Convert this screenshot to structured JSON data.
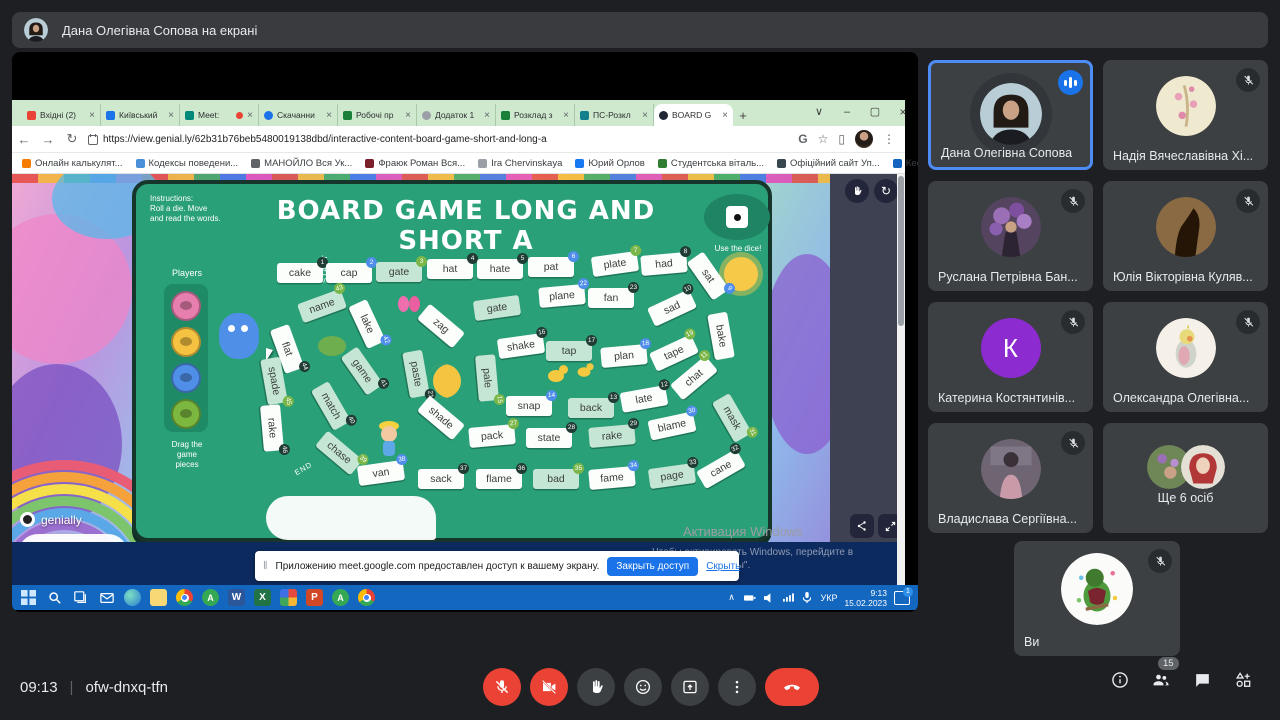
{
  "meet": {
    "banner_text": "Дана Олегівна Сопова на екрані",
    "time": "09:13",
    "code": "ofw-dnxq-tfn",
    "separator": "|",
    "participants_badge": "15"
  },
  "browser": {
    "tabs": [
      {
        "label": "Вхідні (2)",
        "ic": "#ea4335",
        "shape": "square"
      },
      {
        "label": "Київський",
        "ic": "#1a73e8",
        "shape": "square"
      },
      {
        "label": "Meet:",
        "ic": "#00897b",
        "shape": "square",
        "dot": true
      },
      {
        "label": "Скачанни",
        "ic": "#1a73e8",
        "shape": "circle"
      },
      {
        "label": "Робочі пр",
        "ic": "#188038",
        "shape": "square"
      },
      {
        "label": "Додаток 1",
        "ic": "#9aa0a6",
        "shape": "circle"
      },
      {
        "label": "Розклад з",
        "ic": "#188038",
        "shape": "square"
      },
      {
        "label": "ПС-Розкл",
        "ic": "#12808c",
        "shape": "square"
      },
      {
        "label": "BOARD G",
        "ic": "#202633",
        "shape": "circle",
        "active": true
      }
    ],
    "new_tab_button": "+",
    "close_glyph": "×",
    "window_controls": {
      "tab_search": "∨",
      "minimize": "–",
      "maximize": "▢",
      "close": "×"
    },
    "nav": {
      "back": "←",
      "forward": "→",
      "reload": "↻"
    },
    "url": "https://view.genial.ly/62b31b76beb5480019138dbd/interactive-content-board-game-short-and-long-a",
    "toolbar_right": {
      "g": "G",
      "star": "☆",
      "panel": "▯",
      "menu": "⋮"
    },
    "bookmarks": [
      {
        "label": "Онлайн калькулят...",
        "ic": "#f57c00"
      },
      {
        "label": "Кодексы поведени...",
        "ic": "#4a90d9"
      },
      {
        "label": "МАНОЙЛО Вся Ук...",
        "ic": "#5f6368"
      },
      {
        "label": "Фраюк Роман Вся...",
        "ic": "#7b1f2b"
      },
      {
        "label": "Ira Chervinskaya",
        "ic": "#9aa0a6"
      },
      {
        "label": "Юрий Орлов",
        "ic": "#1877f2"
      },
      {
        "label": "Студентська віталь...",
        "ic": "#2e7d32"
      },
      {
        "label": "Офіційний сайт Уп...",
        "ic": "#37474f"
      },
      {
        "label": "Кесем Султан - Все...",
        "ic": "#1565c0"
      }
    ],
    "bookmarks_overflow": "»"
  },
  "game": {
    "instructions_1": "Instructions:",
    "instructions_2": "Roll a die. Move",
    "instructions_3": "and read the words.",
    "title": "BOARD GAME LONG AND SHORT A",
    "use_dice": "Use the dice!",
    "players_label": "Players",
    "drag_label_1": "Drag the",
    "drag_label_2": "game",
    "drag_label_3": "pieces",
    "start_label": "START",
    "end_label": "END",
    "logo": "genially",
    "board_green": "#2aa078",
    "tiles": [
      {
        "word": "cake",
        "num": "1",
        "nc": "d",
        "x": 164,
        "y": 89,
        "r": 0,
        "bg": "w"
      },
      {
        "word": "cap",
        "num": "2",
        "nc": "b",
        "x": 213,
        "y": 89,
        "r": 0,
        "bg": "w"
      },
      {
        "word": "gate",
        "num": "3",
        "nc": "g",
        "x": 263,
        "y": 88,
        "r": 0,
        "bg": "g"
      },
      {
        "word": "hat",
        "num": "4",
        "nc": "d",
        "x": 314,
        "y": 85,
        "r": 0,
        "bg": "w"
      },
      {
        "word": "hate",
        "num": "5",
        "nc": "d",
        "x": 364,
        "y": 85,
        "r": 0,
        "bg": "w"
      },
      {
        "word": "pat",
        "num": "6",
        "nc": "b",
        "x": 415,
        "y": 83,
        "r": 0,
        "bg": "w"
      },
      {
        "word": "plate",
        "num": "7",
        "nc": "g",
        "x": 479,
        "y": 80,
        "r": -8,
        "bg": "w"
      },
      {
        "word": "had",
        "num": "8",
        "nc": "d",
        "x": 528,
        "y": 80,
        "r": -5,
        "bg": "w"
      },
      {
        "word": "sat",
        "num": "9",
        "nc": "b",
        "x": 572,
        "y": 92,
        "r": 55,
        "bg": "w"
      },
      {
        "word": "sad",
        "num": "10",
        "nc": "d",
        "x": 536,
        "y": 124,
        "r": -25,
        "bg": "w"
      },
      {
        "word": "bake",
        "num": "",
        "nc": "d",
        "x": 585,
        "y": 152,
        "r": 80,
        "bg": "w"
      },
      {
        "word": "name",
        "num": "43",
        "nc": "g",
        "x": 186,
        "y": 122,
        "r": -20,
        "bg": "g"
      },
      {
        "word": "lake",
        "num": "42",
        "nc": "b",
        "x": 231,
        "y": 140,
        "r": 65,
        "bg": "w"
      },
      {
        "word": "zag",
        "num": "",
        "nc": "d",
        "x": 305,
        "y": 142,
        "r": 40,
        "bg": "w"
      },
      {
        "word": "gate",
        "num": "",
        "nc": "g",
        "x": 361,
        "y": 124,
        "r": -8,
        "bg": "g"
      },
      {
        "word": "plane",
        "num": "22",
        "nc": "b",
        "x": 426,
        "y": 112,
        "r": -5,
        "bg": "w"
      },
      {
        "word": "fan",
        "num": "23",
        "nc": "d",
        "x": 475,
        "y": 114,
        "r": 0,
        "bg": "w"
      },
      {
        "word": "flat",
        "num": "44",
        "nc": "d",
        "x": 151,
        "y": 165,
        "r": 70,
        "bg": "w"
      },
      {
        "word": "shake",
        "num": "16",
        "nc": "d",
        "x": 385,
        "y": 162,
        "r": -8,
        "bg": "w"
      },
      {
        "word": "tap",
        "num": "17",
        "nc": "d",
        "x": 433,
        "y": 167,
        "r": 0,
        "bg": "g"
      },
      {
        "word": "plan",
        "num": "18",
        "nc": "b",
        "x": 488,
        "y": 172,
        "r": -5,
        "bg": "w"
      },
      {
        "word": "tape",
        "num": "19",
        "nc": "g",
        "x": 538,
        "y": 169,
        "r": -25,
        "bg": "w"
      },
      {
        "word": "spade",
        "num": "45",
        "nc": "g",
        "x": 138,
        "y": 197,
        "r": 80,
        "bg": "g"
      },
      {
        "word": "game",
        "num": "41",
        "nc": "d",
        "x": 226,
        "y": 187,
        "r": 55,
        "bg": "g"
      },
      {
        "word": "paste",
        "num": "21",
        "nc": "d",
        "x": 280,
        "y": 190,
        "r": 80,
        "bg": "g"
      },
      {
        "word": "pale",
        "num": "15",
        "nc": "g",
        "x": 351,
        "y": 194,
        "r": 85,
        "bg": "g"
      },
      {
        "word": "match",
        "num": "40",
        "nc": "d",
        "x": 195,
        "y": 222,
        "r": 60,
        "bg": "g"
      },
      {
        "word": "shade",
        "num": "",
        "nc": "b",
        "x": 305,
        "y": 234,
        "r": 40,
        "bg": "w"
      },
      {
        "word": "snap",
        "num": "14",
        "nc": "b",
        "x": 393,
        "y": 222,
        "r": 0,
        "bg": "w"
      },
      {
        "word": "back",
        "num": "13",
        "nc": "d",
        "x": 455,
        "y": 224,
        "r": 0,
        "bg": "g"
      },
      {
        "word": "late",
        "num": "12",
        "nc": "d",
        "x": 508,
        "y": 215,
        "r": -10,
        "bg": "w"
      },
      {
        "word": "chat",
        "num": "11",
        "nc": "g",
        "x": 558,
        "y": 194,
        "r": -40,
        "bg": "w"
      },
      {
        "word": "rake",
        "num": "46",
        "nc": "d",
        "x": 136,
        "y": 244,
        "r": 85,
        "bg": "w"
      },
      {
        "word": "chase",
        "num": "39",
        "nc": "g",
        "x": 203,
        "y": 269,
        "r": 40,
        "bg": "g"
      },
      {
        "word": "pack",
        "num": "27",
        "nc": "g",
        "x": 356,
        "y": 252,
        "r": -5,
        "bg": "w"
      },
      {
        "word": "state",
        "num": "28",
        "nc": "d",
        "x": 413,
        "y": 254,
        "r": 0,
        "bg": "w"
      },
      {
        "word": "rake",
        "num": "29",
        "nc": "d",
        "x": 476,
        "y": 252,
        "r": -5,
        "bg": "g"
      },
      {
        "word": "blame",
        "num": "30",
        "nc": "b",
        "x": 536,
        "y": 242,
        "r": -12,
        "bg": "w"
      },
      {
        "word": "mask",
        "num": "31",
        "nc": "g",
        "x": 596,
        "y": 234,
        "r": 60,
        "bg": "g"
      },
      {
        "word": "van",
        "num": "38",
        "nc": "b",
        "x": 245,
        "y": 289,
        "r": -8,
        "bg": "w"
      },
      {
        "word": "sack",
        "num": "37",
        "nc": "d",
        "x": 305,
        "y": 295,
        "r": 0,
        "bg": "w"
      },
      {
        "word": "flame",
        "num": "36",
        "nc": "d",
        "x": 363,
        "y": 295,
        "r": 0,
        "bg": "w"
      },
      {
        "word": "bad",
        "num": "35",
        "nc": "g",
        "x": 420,
        "y": 295,
        "r": 0,
        "bg": "g"
      },
      {
        "word": "fame",
        "num": "34",
        "nc": "b",
        "x": 476,
        "y": 294,
        "r": -5,
        "bg": "w"
      },
      {
        "word": "page",
        "num": "33",
        "nc": "d",
        "x": 536,
        "y": 292,
        "r": -8,
        "bg": "g"
      },
      {
        "word": "cane",
        "num": "32",
        "nc": "d",
        "x": 585,
        "y": 285,
        "r": -30,
        "bg": "w"
      }
    ],
    "token_colors": [
      "#e77fae",
      "#f5c242",
      "#4f8fe8",
      "#7cb83f"
    ]
  },
  "page": {
    "toast": {
      "grip": "‖",
      "text": "Приложению meet.google.com предоставлен доступ к вашему экрану.",
      "button": "Закрыть доступ",
      "link": "Скрыть"
    },
    "activation": {
      "l1": "Активация Windows",
      "l2": "Чтобы активировать Windows, перейдите в",
      "l3": "раздел \"Параметры\"."
    }
  },
  "taskbar": {
    "lang": "УКР",
    "time": "9:13",
    "date": "15.02.2023",
    "badge": "1",
    "apps": [
      "start",
      "search",
      "task-view",
      "mail",
      "edge",
      "explorer",
      "chrome",
      "chrome-profile-a",
      "word",
      "excel",
      "office",
      "powerpoint",
      "chrome-profile-b",
      "chrome-2"
    ],
    "app_letters": {
      "word": "W",
      "excel": "X",
      "powerpoint": "P",
      "chrome_profile": "A"
    }
  },
  "participants": [
    {
      "name": "Дана Олегівна Сопова",
      "muted": false,
      "speaking": true,
      "avatar": "photo-woman"
    },
    {
      "name": "Надія Вячеславівна Хі...",
      "muted": true,
      "avatar": "blossom"
    },
    {
      "name": "Руслана Петрівна Бан...",
      "muted": true,
      "avatar": "lilac"
    },
    {
      "name": "Юлія Вікторівна Куляв...",
      "muted": true,
      "avatar": "sepia"
    },
    {
      "name": "Катерина Костянтинів...",
      "muted": true,
      "avatar": "letter",
      "initial": "К",
      "color": "#8c2bd0"
    },
    {
      "name": "Олександра Олегівна...",
      "muted": true,
      "avatar": "cockatiel"
    },
    {
      "name": "Владислава Сергіївна...",
      "muted": true,
      "avatar": "winter"
    },
    {
      "name": "Ще 6 осіб",
      "muted": false,
      "avatar": "pair",
      "others": true
    },
    {
      "name": "Ви",
      "muted": true,
      "avatar": "parrot",
      "you": true
    }
  ],
  "colors": {
    "accent_blue": "#1a73e8",
    "speaking_border": "#4e8cf5",
    "danger_red": "#ea4335",
    "taskbar_blue": "#1367bf"
  }
}
